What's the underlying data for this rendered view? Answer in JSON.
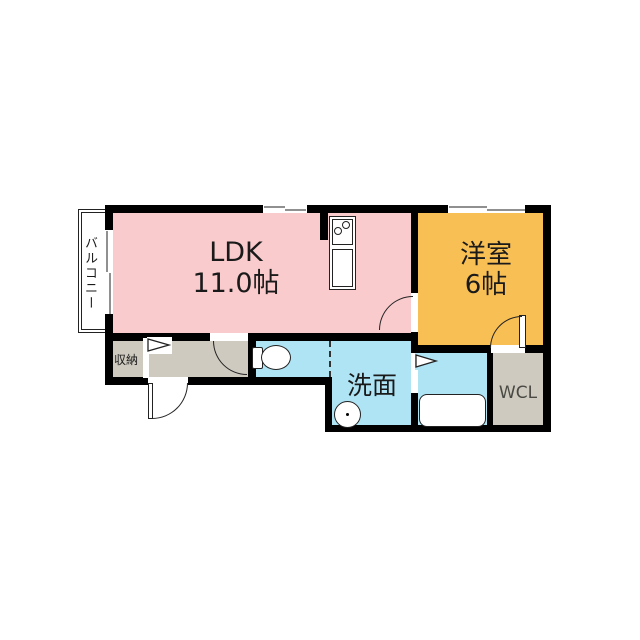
{
  "plan": {
    "rooms": {
      "balcony": {
        "label": "バルコニー"
      },
      "ldk": {
        "label": "LDK",
        "size": "11.0帖"
      },
      "bedroom": {
        "label": "洋室",
        "size": "6帖"
      },
      "storage": {
        "label": "収納"
      },
      "washroom": {
        "label": "洗面"
      },
      "wcl": {
        "label": "WCL"
      }
    }
  },
  "colors": {
    "ldk": "#f9cbcd",
    "bedroom": "#f8bf55",
    "wet": "#aee4f4",
    "hall": "#cecabf",
    "wall": "#000000",
    "window": "#909090",
    "line": "#222222",
    "text": "#1a1a1a",
    "wcltext": "#4a4a44"
  }
}
